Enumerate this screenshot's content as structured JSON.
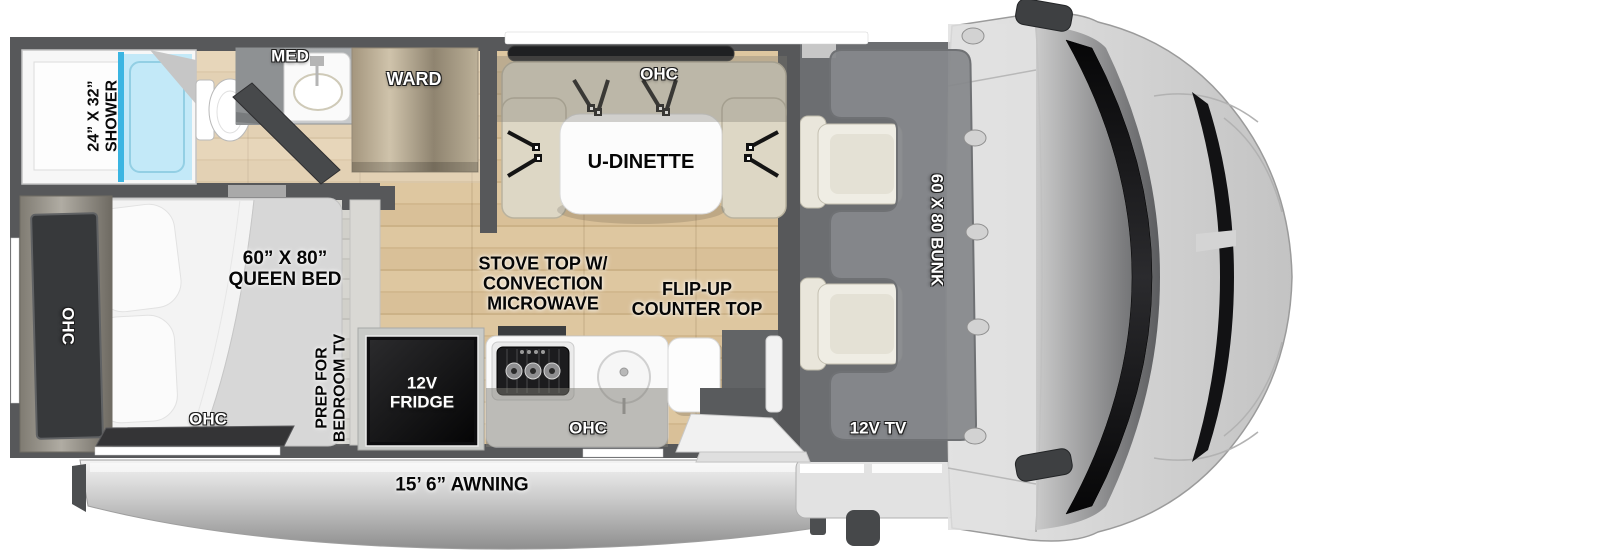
{
  "floorplan": {
    "bathroom": {
      "shower_lines": [
        "24” X 32”",
        "SHOWER"
      ],
      "med": "MED",
      "ward": "WARD"
    },
    "dinette": {
      "ohc": "OHC",
      "name": "U-DINETTE"
    },
    "bedroom": {
      "bed_lines": [
        "60” X 80”",
        "QUEEN BED"
      ],
      "ohc_side": "OHC",
      "ohc_bottom": "OHC",
      "prep_lines": [
        "PREP FOR",
        "BEDROOM TV"
      ]
    },
    "kitchen": {
      "stove_lines": [
        "STOVE TOP W/",
        "CONVECTION",
        "MICROWAVE"
      ],
      "flip_lines": [
        "FLIP-UP",
        "COUNTER TOP"
      ],
      "fridge_lines": [
        "12V",
        "FRIDGE"
      ],
      "ohc": "OHC"
    },
    "cab": {
      "bunk": "60 X 80 BUNK",
      "tv": "12V TV"
    },
    "exterior": {
      "awning": "15’ 6” AWNING"
    },
    "colors": {
      "wall": "#57585a",
      "floor_wood": "#d8bf97",
      "floor_bedroom": "#d1d0ca",
      "shower_blue": "#c3e9f8",
      "glass_blue": "#3ab5e2",
      "seat_beige": "#ddd7c5",
      "bunk_gray": "#87888b",
      "cab_gray": "#d6d6d6",
      "windshield_black": "#121214",
      "awning_silver": "#c9c9c9",
      "label_white": "#ffffff",
      "label_black": "#0a0a0a"
    }
  }
}
